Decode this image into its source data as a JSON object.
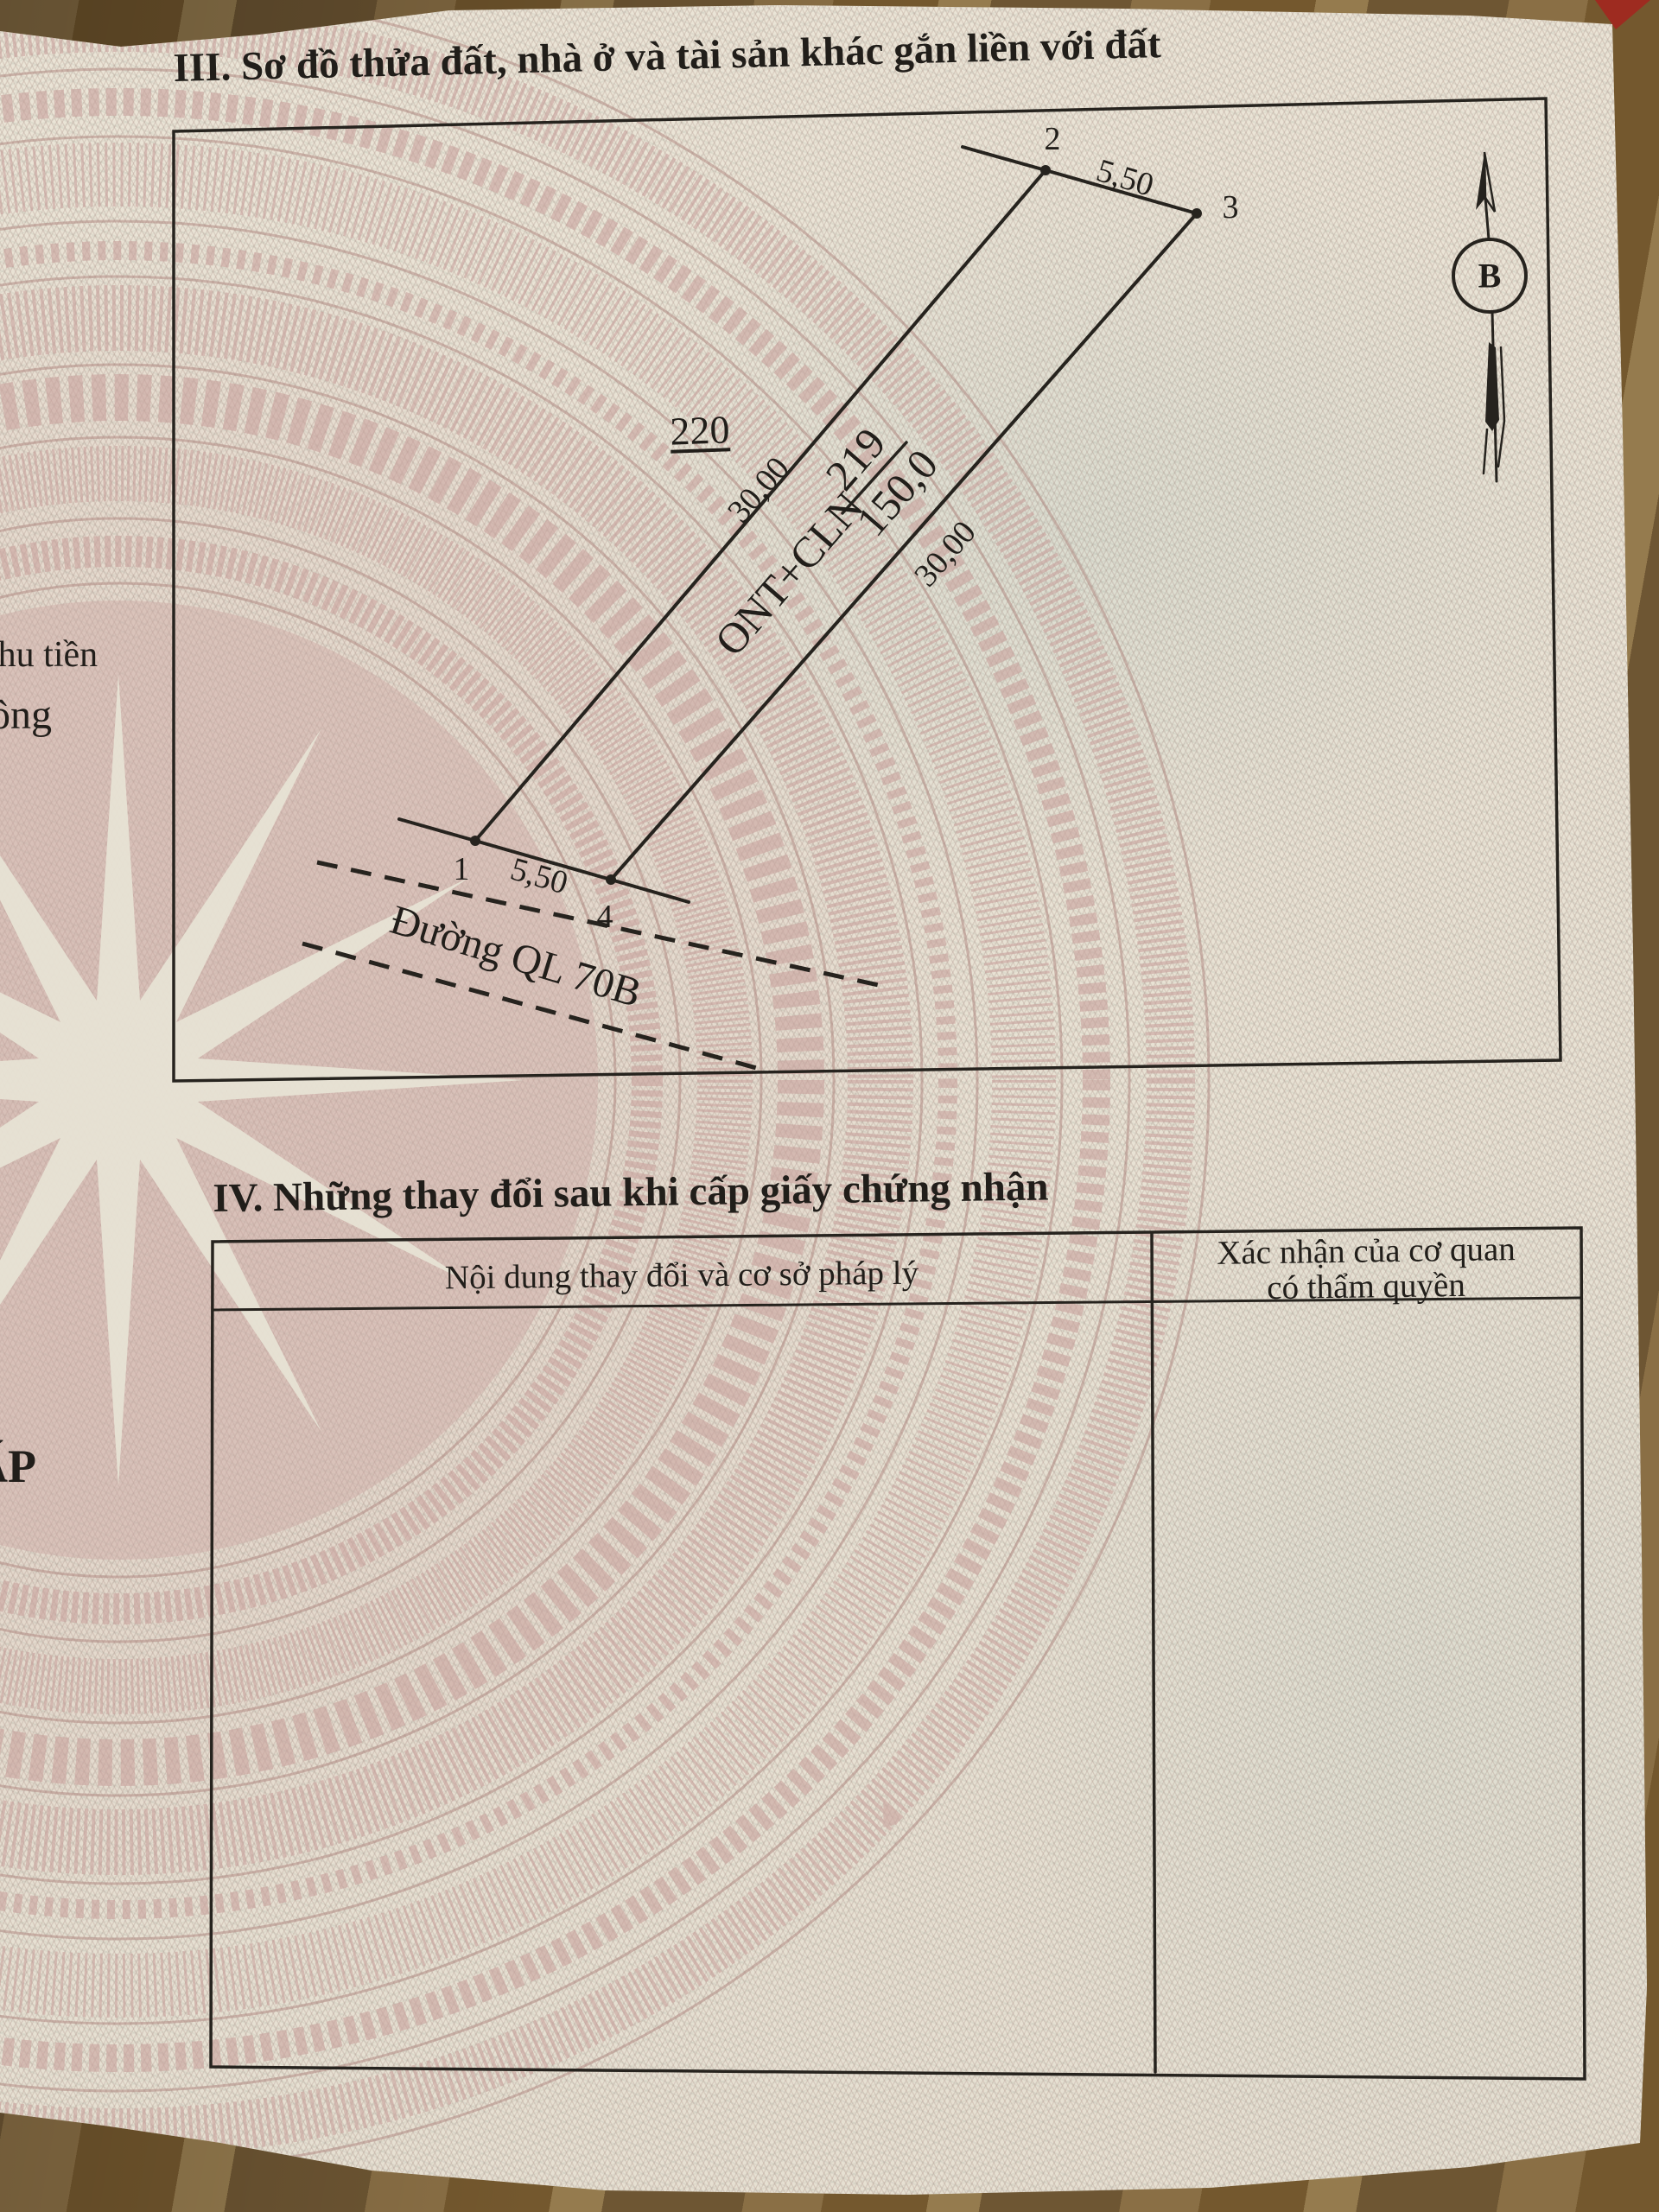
{
  "section_iii": {
    "title": "III. Sơ đồ thửa đất, nhà ở và tài sản khác gắn liền với đất",
    "plot_diagram": {
      "adjacent_parcel_number": "220",
      "parcel_use_code": "ONT+CLN",
      "parcel_number": "219",
      "parcel_area": "150,0",
      "top_edge_length": "5,50",
      "left_edge_length": "30,00",
      "right_edge_length": "30,00",
      "bottom_edge_length": "5,50",
      "vertex_1": "1",
      "vertex_2": "2",
      "vertex_3": "3",
      "vertex_4": "4",
      "road_name": "Đường QL 70B",
      "north_marker": "B"
    }
  },
  "section_iv": {
    "title": "IV. Những thay đổi sau khi cấp giấy chứng nhận",
    "table": {
      "col_content_header": "Nội dung thay đổi và cơ sở pháp lý",
      "col_confirm_header_line1": "Xác nhận của cơ quan",
      "col_confirm_header_line2": "có thẩm quyền"
    }
  },
  "left_page_fragments": {
    "fragment_1": "thu tiền",
    "fragment_2": "ông",
    "fragment_3": "ẤP"
  },
  "colors": {
    "ink": "#211e1a",
    "paper": "#e9e3d5",
    "pattern_pink": "#c9a6a2",
    "mesh_green": "#cdd6cb",
    "cover_red": "#9e2b20",
    "wood_brown": "#7b613a"
  }
}
